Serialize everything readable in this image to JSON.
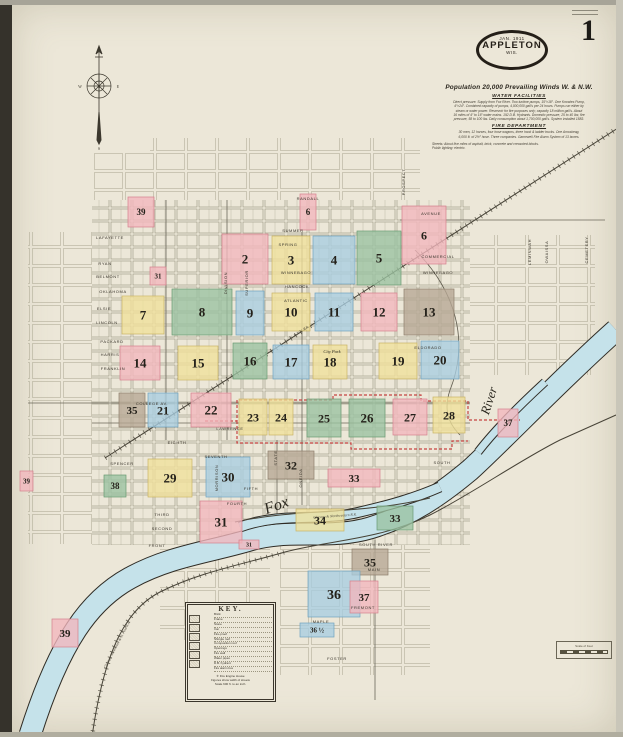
{
  "page": {
    "sheet_number": "1"
  },
  "title_oval": {
    "date": "JAN. 1911",
    "city": "APPLETON",
    "state": "WIS."
  },
  "info": {
    "population_line": "Population 20,000   Prevailing Winds W. & N.W.",
    "water_heading": "WATER FACILITIES",
    "water_lines": [
      "Direct pressure. Supply from Fox River. Two turbine pumps, 15″×18″. One Knowles Pump,",
      "4″×24″. Combined capacity of pumps, 4,000,000 gall's per 24 hours. Pumps run either by",
      "steam or water power. Reservoir for fire purposes only; capacity 18 million gall's. About",
      "16 miles of 4″ to 16″ water mains. 192 D.B. Hydrants. Domestic pressure, 25 to 40 lbs; fire",
      "pressure, 58 to 100 lbs. Daily consumption about 1,700,000 gall's. System installed 1883."
    ],
    "fire_heading": "FIRE DEPARTMENT",
    "fire_lines": [
      "30 men, 12 horses, four hose wagons, three hook & ladder trucks. One Amoskeag,",
      "6,000 ft. of 2½″ hose. Three companies. Gamewell Fire Alarm System of 13 boxes."
    ],
    "streets_lines": [
      "Streets: About five miles of asphalt, brick, concrete and creosoted blocks.",
      "Public lighting: electric."
    ]
  },
  "compass": {
    "n": "N",
    "e": "E",
    "s": "S",
    "w": "W"
  },
  "map": {
    "colors": {
      "pink": {
        "fill": "#f2b6bd",
        "stroke": "#d4808d"
      },
      "yellow": {
        "fill": "#efe09a",
        "stroke": "#c9b465"
      },
      "blue": {
        "fill": "#a8cde0",
        "stroke": "#6fa3bf"
      },
      "green": {
        "fill": "#9ac2a0",
        "stroke": "#699a73"
      },
      "taupe": {
        "fill": "#b6a794",
        "stroke": "#8d7e6b"
      }
    },
    "blocks": [
      {
        "num": "39",
        "x": 128,
        "y": 197,
        "w": 26,
        "h": 30,
        "color": "pink",
        "fs": 9
      },
      {
        "num": "6",
        "x": 300,
        "y": 194,
        "w": 16,
        "h": 36,
        "color": "pink",
        "fs": 9
      },
      {
        "num": "6",
        "x": 402,
        "y": 206,
        "w": 44,
        "h": 58,
        "color": "pink",
        "fs": 12
      },
      {
        "num": "2",
        "x": 222,
        "y": 234,
        "w": 46,
        "h": 50,
        "color": "pink",
        "fs": 13
      },
      {
        "num": "3",
        "x": 272,
        "y": 236,
        "w": 38,
        "h": 48,
        "color": "yellow",
        "fs": 13
      },
      {
        "num": "4",
        "x": 313,
        "y": 236,
        "w": 42,
        "h": 48,
        "color": "blue",
        "fs": 13
      },
      {
        "num": "5",
        "x": 357,
        "y": 231,
        "w": 44,
        "h": 54,
        "color": "green",
        "fs": 13
      },
      {
        "num": "31",
        "x": 150,
        "y": 267,
        "w": 16,
        "h": 18,
        "color": "pink",
        "fs": 7
      },
      {
        "num": "7",
        "x": 122,
        "y": 296,
        "w": 42,
        "h": 38,
        "color": "yellow",
        "fs": 13
      },
      {
        "num": "8",
        "x": 172,
        "y": 289,
        "w": 60,
        "h": 46,
        "color": "green",
        "fs": 13
      },
      {
        "num": "9",
        "x": 236,
        "y": 291,
        "w": 28,
        "h": 44,
        "color": "blue",
        "fs": 13
      },
      {
        "num": "10",
        "x": 272,
        "y": 293,
        "w": 38,
        "h": 38,
        "color": "yellow",
        "fs": 13
      },
      {
        "num": "11",
        "x": 315,
        "y": 293,
        "w": 38,
        "h": 38,
        "color": "blue",
        "fs": 13
      },
      {
        "num": "12",
        "x": 361,
        "y": 293,
        "w": 36,
        "h": 38,
        "color": "pink",
        "fs": 13
      },
      {
        "num": "13",
        "x": 404,
        "y": 289,
        "w": 50,
        "h": 46,
        "color": "taupe",
        "fs": 13
      },
      {
        "num": "14",
        "x": 120,
        "y": 346,
        "w": 40,
        "h": 34,
        "color": "pink",
        "fs": 13
      },
      {
        "num": "15",
        "x": 178,
        "y": 346,
        "w": 40,
        "h": 34,
        "color": "yellow",
        "fs": 13
      },
      {
        "num": "16",
        "x": 233,
        "y": 343,
        "w": 34,
        "h": 36,
        "color": "green",
        "fs": 13
      },
      {
        "num": "17",
        "x": 273,
        "y": 345,
        "w": 36,
        "h": 34,
        "color": "blue",
        "fs": 13
      },
      {
        "num": "18",
        "x": 313,
        "y": 345,
        "w": 34,
        "h": 34,
        "color": "yellow",
        "fs": 13
      },
      {
        "num": "19",
        "x": 379,
        "y": 343,
        "w": 38,
        "h": 36,
        "color": "yellow",
        "fs": 13
      },
      {
        "num": "20",
        "x": 421,
        "y": 341,
        "w": 38,
        "h": 38,
        "color": "blue",
        "fs": 13
      },
      {
        "num": "35",
        "x": 119,
        "y": 393,
        "w": 26,
        "h": 34,
        "color": "taupe",
        "fs": 11
      },
      {
        "num": "21",
        "x": 148,
        "y": 393,
        "w": 30,
        "h": 34,
        "color": "blue",
        "fs": 12
      },
      {
        "num": "22",
        "x": 191,
        "y": 393,
        "w": 40,
        "h": 34,
        "color": "pink",
        "fs": 13
      },
      {
        "num": "23",
        "x": 239,
        "y": 399,
        "w": 28,
        "h": 36,
        "color": "yellow",
        "fs": 12
      },
      {
        "num": "24",
        "x": 269,
        "y": 399,
        "w": 24,
        "h": 36,
        "color": "yellow",
        "fs": 12
      },
      {
        "num": "25",
        "x": 307,
        "y": 399,
        "w": 34,
        "h": 38,
        "color": "green",
        "fs": 12
      },
      {
        "num": "26",
        "x": 349,
        "y": 399,
        "w": 36,
        "h": 38,
        "color": "green",
        "fs": 13
      },
      {
        "num": "27",
        "x": 393,
        "y": 399,
        "w": 34,
        "h": 36,
        "color": "pink",
        "fs": 12
      },
      {
        "num": "28",
        "x": 433,
        "y": 397,
        "w": 32,
        "h": 36,
        "color": "yellow",
        "fs": 12
      },
      {
        "num": "29",
        "x": 148,
        "y": 459,
        "w": 44,
        "h": 38,
        "color": "yellow",
        "fs": 13
      },
      {
        "num": "30",
        "x": 206,
        "y": 457,
        "w": 44,
        "h": 40,
        "color": "blue",
        "fs": 13
      },
      {
        "num": "38",
        "x": 104,
        "y": 475,
        "w": 22,
        "h": 22,
        "color": "green",
        "fs": 9
      },
      {
        "num": "31",
        "x": 200,
        "y": 501,
        "w": 42,
        "h": 42,
        "color": "pink",
        "fs": 13
      },
      {
        "num": "31",
        "x": 239,
        "y": 540,
        "w": 20,
        "h": 9,
        "color": "pink",
        "fs": 6
      },
      {
        "num": "32",
        "x": 268,
        "y": 451,
        "w": 46,
        "h": 28,
        "color": "taupe",
        "fs": 12
      },
      {
        "num": "33",
        "x": 328,
        "y": 469,
        "w": 52,
        "h": 18,
        "color": "pink",
        "fs": 11
      },
      {
        "num": "34",
        "x": 296,
        "y": 509,
        "w": 48,
        "h": 22,
        "color": "yellow",
        "fs": 12
      },
      {
        "num": "33",
        "x": 377,
        "y": 506,
        "w": 36,
        "h": 24,
        "color": "green",
        "fs": 11
      },
      {
        "num": "37",
        "x": 498,
        "y": 409,
        "w": 20,
        "h": 28,
        "color": "pink",
        "fs": 9
      },
      {
        "num": "35",
        "x": 352,
        "y": 549,
        "w": 36,
        "h": 26,
        "color": "taupe",
        "fs": 12
      },
      {
        "num": "36",
        "x": 308,
        "y": 571,
        "w": 52,
        "h": 46,
        "color": "blue",
        "fs": 14
      },
      {
        "num": "37",
        "x": 350,
        "y": 581,
        "w": 28,
        "h": 32,
        "color": "pink",
        "fs": 11
      },
      {
        "num": "36 ½",
        "x": 300,
        "y": 623,
        "w": 34,
        "h": 14,
        "color": "blue",
        "fs": 7
      },
      {
        "num": "39",
        "x": 20,
        "y": 471,
        "w": 13,
        "h": 20,
        "color": "pink",
        "fs": 7
      },
      {
        "num": "39",
        "x": 52,
        "y": 619,
        "w": 26,
        "h": 28,
        "color": "pink",
        "fs": 11
      }
    ],
    "street_labels": [
      {
        "t": "SUMMER",
        "x": 293,
        "y": 232,
        "r": 0
      },
      {
        "t": "SPRING",
        "x": 288,
        "y": 246,
        "r": 0
      },
      {
        "t": "WINNEBAGO",
        "x": 296,
        "y": 274,
        "r": 0
      },
      {
        "t": "HANCOCK",
        "x": 297,
        "y": 288,
        "r": 0
      },
      {
        "t": "ATLANTIC",
        "x": 296,
        "y": 302,
        "r": 0
      },
      {
        "t": "COMMERCIAL",
        "x": 438,
        "y": 258,
        "r": 0
      },
      {
        "t": "WINNEBAGO",
        "x": 438,
        "y": 274,
        "r": 0
      },
      {
        "t": "AVENUE",
        "x": 431,
        "y": 215,
        "r": 0
      },
      {
        "t": "RANDALL",
        "x": 308,
        "y": 200,
        "r": 0
      },
      {
        "t": "LAFAYETTE",
        "x": 110,
        "y": 239,
        "r": 0
      },
      {
        "t": "RYAN",
        "x": 105,
        "y": 265,
        "r": 0
      },
      {
        "t": "BELMONT",
        "x": 108,
        "y": 278,
        "r": 0
      },
      {
        "t": "OKLAHOMA",
        "x": 113,
        "y": 293,
        "r": 0
      },
      {
        "t": "ELSIE",
        "x": 104,
        "y": 310,
        "r": 0
      },
      {
        "t": "LINCOLN",
        "x": 107,
        "y": 324,
        "r": 0
      },
      {
        "t": "PACKARD",
        "x": 112,
        "y": 343,
        "r": 0
      },
      {
        "t": "HARRIS",
        "x": 110,
        "y": 356,
        "r": 0
      },
      {
        "t": "FRANKLIN",
        "x": 113,
        "y": 370,
        "r": 0
      },
      {
        "t": "COLLEGE AV.",
        "x": 152,
        "y": 405,
        "r": 0
      },
      {
        "t": "LAWRENCE",
        "x": 230,
        "y": 430,
        "r": 0
      },
      {
        "t": "EIGHTH",
        "x": 177,
        "y": 444,
        "r": 0
      },
      {
        "t": "SEVENTH",
        "x": 216,
        "y": 458,
        "r": 0
      },
      {
        "t": "FIFTH",
        "x": 251,
        "y": 490,
        "r": 0
      },
      {
        "t": "FOURTH",
        "x": 237,
        "y": 505,
        "r": 0
      },
      {
        "t": "THIRD",
        "x": 162,
        "y": 516,
        "r": 0
      },
      {
        "t": "SECOND",
        "x": 162,
        "y": 530,
        "r": 0
      },
      {
        "t": "FRONT",
        "x": 157,
        "y": 547,
        "r": 0
      },
      {
        "t": "SPENCER",
        "x": 122,
        "y": 465,
        "r": 0
      },
      {
        "t": "SOUTH",
        "x": 442,
        "y": 464,
        "r": 0
      },
      {
        "t": "ELDORADO",
        "x": 428,
        "y": 349,
        "r": 0
      },
      {
        "t": "SOUTH RIVER",
        "x": 376,
        "y": 546,
        "r": 0
      },
      {
        "t": "MAIN",
        "x": 374,
        "y": 571,
        "r": 0
      },
      {
        "t": "FREMONT",
        "x": 363,
        "y": 609,
        "r": 0
      },
      {
        "t": "MAPLE",
        "x": 321,
        "y": 623,
        "r": 0
      },
      {
        "t": "FOSTER",
        "x": 337,
        "y": 660,
        "r": 0
      },
      {
        "t": "DIVISION",
        "x": 227,
        "y": 283,
        "r": -90
      },
      {
        "t": "SUPERIOR",
        "x": 248,
        "y": 283,
        "r": -90
      },
      {
        "t": "STATE",
        "x": 277,
        "y": 458,
        "r": -90
      },
      {
        "t": "MORRISON",
        "x": 218,
        "y": 478,
        "r": -90
      },
      {
        "t": "ONEIDA",
        "x": 302,
        "y": 478,
        "r": -90
      },
      {
        "t": "PROSPECT",
        "x": 405,
        "y": 182,
        "r": -90
      },
      {
        "t": "LEMINWAH",
        "x": 531,
        "y": 252,
        "r": -90
      },
      {
        "t": "OWAISSA",
        "x": 548,
        "y": 252,
        "r": -90
      },
      {
        "t": "CEMETERY",
        "x": 588,
        "y": 250,
        "r": -90
      }
    ],
    "place_labels": [
      {
        "t": "Fox",
        "x": 278,
        "y": 510,
        "r": -20,
        "fs": 16
      },
      {
        "t": "River",
        "x": 493,
        "y": 402,
        "r": -72,
        "fs": 13
      },
      {
        "t": "City Park",
        "x": 332,
        "y": 353,
        "r": 0,
        "fs": 4.5
      }
    ],
    "railroad_labels": [
      {
        "t": "Chicago, Milwaukee & St. Paul R.R.",
        "x": 118,
        "y": 645,
        "r": -62
      },
      {
        "t": "Chicago & Northwestern R.R.",
        "x": 335,
        "y": 517,
        "r": -4
      },
      {
        "t": "C. & N.W. R.R.",
        "x": 300,
        "y": 333,
        "r": -33
      }
    ]
  },
  "key": {
    "title": "KEY.",
    "rows": [
      "Brick",
      "Frame",
      "Stone",
      "Iron",
      "Fire-proof",
      "Shingle roof",
      "Composition roof",
      "Openings",
      "Fire wall",
      "Water pipes",
      "D.B. hydrant",
      "Fire alarm box"
    ],
    "fire_house_line": "✛  Fire Engine House",
    "width_line": "Figures show width of streets",
    "scale_line": "Scale 600 ft. to an inch."
  },
  "stamp": {
    "label": "Scale of Feet"
  }
}
